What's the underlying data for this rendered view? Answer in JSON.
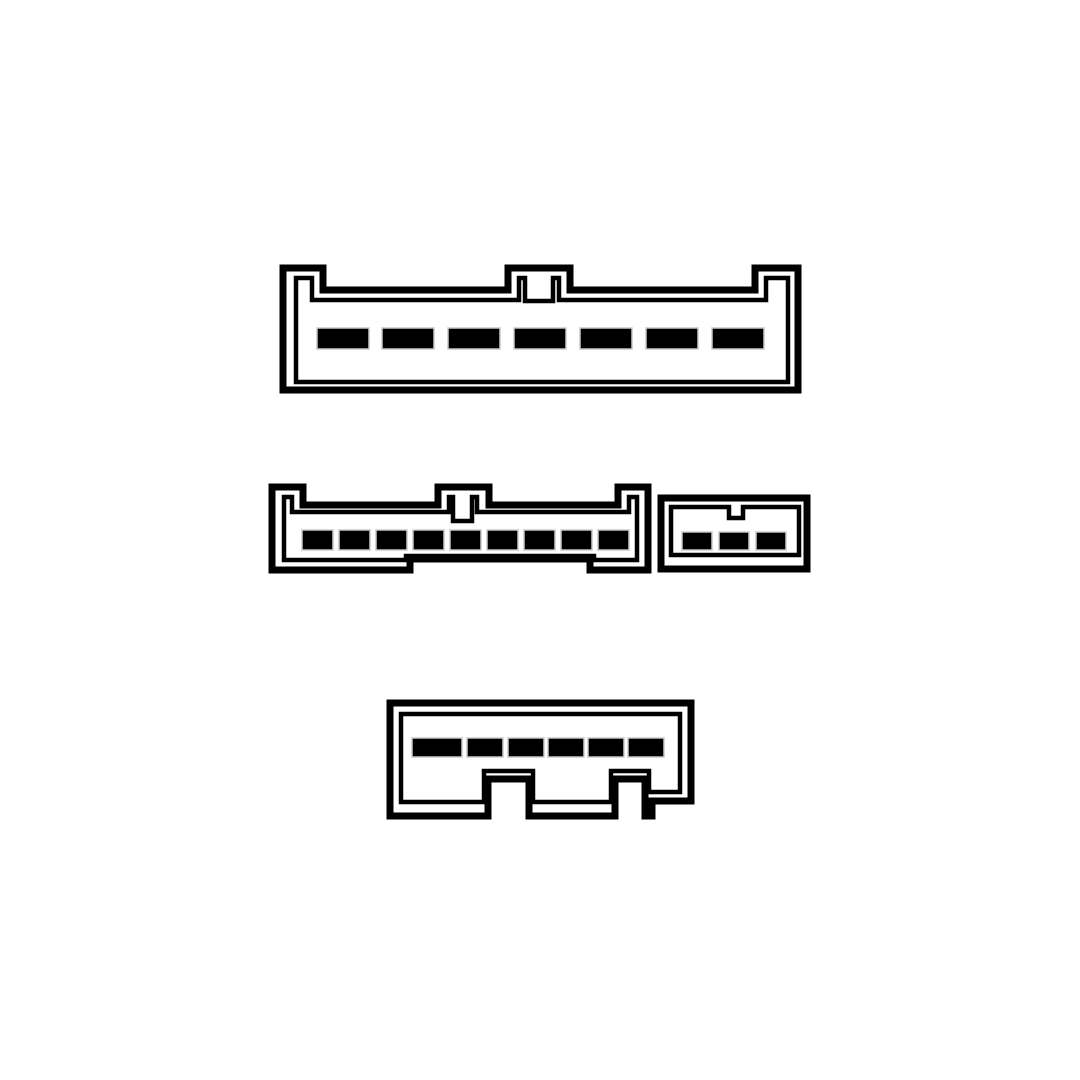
{
  "diagram": {
    "kind": "wiring-connector-pinout",
    "canvas": {
      "width": 1080,
      "height": 1080,
      "background": "#ffffff"
    },
    "line_color": "#000000",
    "pin_fill": "#000000",
    "pin_edge": "#c8c8c8",
    "outer_stroke_width": 7,
    "inner_stroke_width": 4.5,
    "connectors": [
      {
        "id": "connector-top-7pin",
        "label": "7-slot connector with three top keying tabs",
        "pin_count": 7,
        "outer_path": "M283,268 L323,268 L323,290 L508,290 L508,268 L570,268 L570,290 L755,290 L755,268 L798,268 L798,390 L283,390 Z",
        "inner_path": "M296,278 L312,278 L312,300 L519,300 L519,278 L525,278 L525,301 L553,301 L553,278 L559,278 L559,300 L766,300 L766,278 L788,278 L788,382 L296,382 Z",
        "pins": [
          {
            "x": 317,
            "y": 328,
            "w": 52,
            "h": 21
          },
          {
            "x": 382,
            "y": 328,
            "w": 52,
            "h": 21
          },
          {
            "x": 448,
            "y": 328,
            "w": 52,
            "h": 21
          },
          {
            "x": 514,
            "y": 328,
            "w": 52,
            "h": 21
          },
          {
            "x": 580,
            "y": 328,
            "w": 52,
            "h": 21
          },
          {
            "x": 646,
            "y": 328,
            "w": 52,
            "h": 21
          },
          {
            "x": 712,
            "y": 328,
            "w": 52,
            "h": 21
          }
        ]
      },
      {
        "id": "connector-middle-left-9pin",
        "label": "9-slot connector with keyed top tabs and stepped bottom flanges",
        "pin_count": 9,
        "outer_path": "M272,487 L303,487 L303,505 L438,505 L438,487 L489,487 L489,505 L618,505 L618,487 L648,487 L648,570 L590,570 L590,559 L410,559 L410,570 L272,570 Z",
        "inner_path": "M284,497 L292,497 L292,512 L449,512 L449,497 L453,497 L453,521 L472,521 L472,497 L477,497 L477,512 L629,512 L629,497 L637,497 L637,560 L594,560 L594,556 L406,556 L406,560 L284,560 Z",
        "pins": [
          {
            "x": 302,
            "y": 530,
            "w": 31,
            "h": 20
          },
          {
            "x": 339,
            "y": 530,
            "w": 31,
            "h": 20
          },
          {
            "x": 376,
            "y": 530,
            "w": 31,
            "h": 20
          },
          {
            "x": 413,
            "y": 530,
            "w": 31,
            "h": 20
          },
          {
            "x": 450,
            "y": 530,
            "w": 31,
            "h": 20
          },
          {
            "x": 487,
            "y": 530,
            "w": 31,
            "h": 20
          },
          {
            "x": 524,
            "y": 530,
            "w": 31,
            "h": 20
          },
          {
            "x": 561,
            "y": 530,
            "w": 31,
            "h": 20
          },
          {
            "x": 598,
            "y": 530,
            "w": 31,
            "h": 20
          }
        ]
      },
      {
        "id": "connector-middle-right-3pin",
        "label": "3-slot connector with top keying notch",
        "pin_count": 3,
        "outer_path": "M661,498 L807,498 L807,569 L661,569 Z",
        "inner_path": "M671,507 L729,507 L729,518 L743,518 L743,507 L799,507 L799,555 L671,555 Z",
        "pins": [
          {
            "x": 682,
            "y": 532,
            "w": 30,
            "h": 18
          },
          {
            "x": 719,
            "y": 532,
            "w": 30,
            "h": 18
          },
          {
            "x": 756,
            "y": 532,
            "w": 30,
            "h": 18
          }
        ]
      },
      {
        "id": "connector-bottom-6pin",
        "label": "6-slot connector with two bottom keying slots and raised bottom-right corner",
        "pin_count": 6,
        "outer_path": "M390,703 L691,703 L691,801 L652,801 L652,816 L645,816 L645,779 L615,779 L615,816 L529,816 L529,779 L488,779 L488,816 L390,816 Z",
        "inner_path": "M401,714 L680,714 L680,792 L649,792 L649,771 L611,771 L611,802 L533,802 L533,771 L484,771 L484,802 L401,802 Z",
        "pins": [
          {
            "x": 412,
            "y": 738,
            "w": 50,
            "h": 19
          },
          {
            "x": 467,
            "y": 738,
            "w": 36,
            "h": 19
          },
          {
            "x": 508,
            "y": 738,
            "w": 36,
            "h": 19
          },
          {
            "x": 548,
            "y": 738,
            "w": 36,
            "h": 19
          },
          {
            "x": 588,
            "y": 738,
            "w": 36,
            "h": 19
          },
          {
            "x": 628,
            "y": 738,
            "w": 36,
            "h": 19
          }
        ]
      }
    ]
  }
}
